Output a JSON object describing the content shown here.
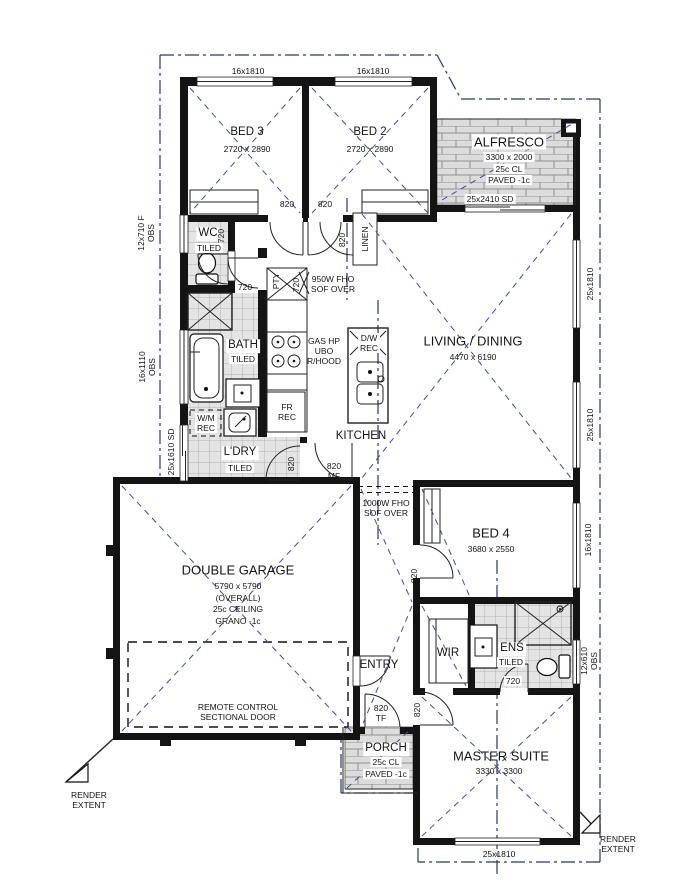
{
  "rooms": {
    "bed3": {
      "name": "BED 3",
      "dims": "2720 x 2890"
    },
    "bed2": {
      "name": "BED 2",
      "dims": "2720 x 2890"
    },
    "bed4": {
      "name": "BED 4",
      "dims": "3680 x 2550"
    },
    "master": {
      "name": "MASTER SUITE",
      "dims": "3330 x 3300"
    },
    "living": {
      "name": "LIVING / DINING",
      "dims": "4470 x 6190"
    },
    "kitchen": {
      "name": "KITCHEN"
    },
    "garage": {
      "name": "DOUBLE GARAGE",
      "dims": "5790 x 5790",
      "note1": "(OVERALL)",
      "note2": "25c CEILING",
      "note3": "GRANO -1c"
    },
    "alfresco": {
      "name": "ALFRESCO",
      "dims": "3300 x 2000",
      "ceiling": "25c CL",
      "floor": "PAVED -1c"
    },
    "porch": {
      "name": "PORCH",
      "ceiling": "25c CL",
      "floor": "PAVED -1c"
    },
    "wc": {
      "name": "WC",
      "finish": "TILED"
    },
    "bath": {
      "name": "BATH",
      "finish": "TILED"
    },
    "ldry": {
      "name": "L'DRY",
      "finish": "TILED"
    },
    "ens": {
      "name": "ENS",
      "finish": "TILED"
    },
    "entry": {
      "name": "ENTRY"
    },
    "wir": {
      "name": "WIR"
    },
    "linen": {
      "name": "LINEN"
    },
    "pty": {
      "name": "PTY"
    }
  },
  "windows": {
    "w16x1810": "16x1810",
    "w25x1810": "25x1810",
    "left1": "12x710 F\nOBS",
    "left2": "16x1110\nOBS",
    "left3": "25x1610 SD",
    "right4": "12x610\nOBS",
    "alfresco_sd": "25x2410 SD"
  },
  "doors": {
    "d820": "820",
    "d720": "720",
    "mf": "820\nMF",
    "tf": "820\nTF"
  },
  "annotations": {
    "sof950": "950W FHO\nSOF OVER",
    "sof1000": "1000W FHO\nSOF OVER",
    "gas": "GAS HP\nUBO\nR/HOOD",
    "fr": "FR\nREC",
    "wm": "W/M\nREC",
    "dw": "D/W\nREC",
    "remote": "REMOTE CONTROL\nSECTIONAL DOOR",
    "render_extent": "RENDER\nEXTENT"
  }
}
